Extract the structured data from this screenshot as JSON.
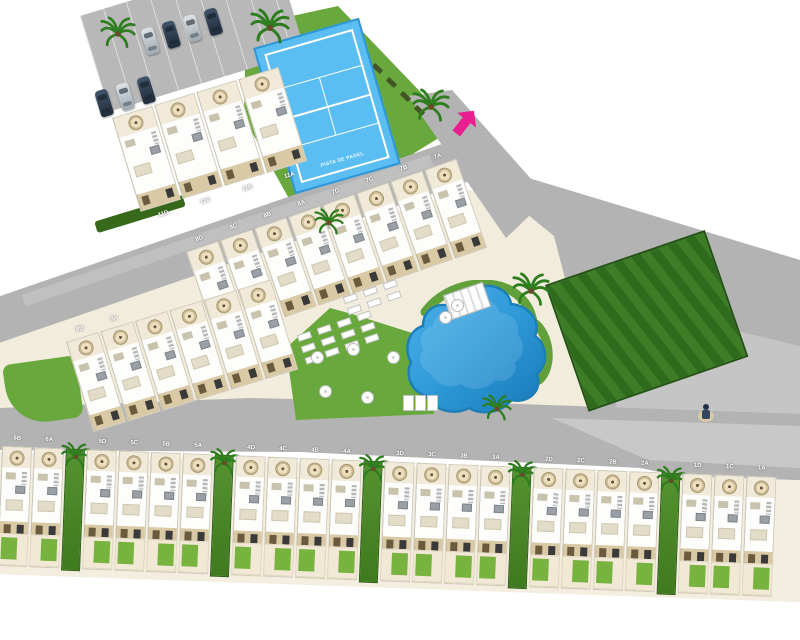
{
  "plan": {
    "type": "residential-site-plan",
    "padel_court_label": "PISTA DE PADEL",
    "colors": {
      "grass": "#69a83d",
      "grass_dark": "#3f7a1f",
      "hedge": "#36691a",
      "road": "#b3b3b3",
      "road_light": "#c8c8c8",
      "path": "#f2ecdc",
      "court_blue": "#5bbef3",
      "court_line": "#ffffff",
      "pool_blue": "#2e9ad8",
      "pool_deep": "#1879b8",
      "arrow_pink": "#ea1f8f",
      "house_white": "#fdfdfb",
      "terrace_tan": "#d9c9a4"
    },
    "rows": {
      "block11": {
        "name": "Block 11",
        "units": [
          "11D",
          "11C",
          "11B",
          "11A"
        ]
      },
      "row78": {
        "name": "Blocks 7-8",
        "units": [
          "8D",
          "8C",
          "8B",
          "8A",
          "7D",
          "7C",
          "7B",
          "7A"
        ]
      },
      "row9": {
        "name": "Block 9",
        "units": [
          "9B",
          "9A",
          "",
          "",
          "",
          ""
        ]
      },
      "bottom": {
        "name": "Blocks 1-6",
        "units": [
          "6B",
          "6A",
          "5D",
          "5C",
          "5B",
          "5A",
          "4D",
          "4C",
          "4B",
          "4A",
          "3D",
          "3C",
          "3B",
          "3A",
          "2D",
          "2C",
          "2B",
          "2A",
          "1D",
          "1C",
          "1A"
        ],
        "block_breaks_after": [
          "6A",
          "5A",
          "4A",
          "3A",
          "2A"
        ]
      }
    },
    "parking": {
      "rows": [
        [
          "silver",
          "dark",
          "silver",
          "dark"
        ],
        [
          "dark",
          "silver",
          "dark"
        ]
      ]
    }
  }
}
